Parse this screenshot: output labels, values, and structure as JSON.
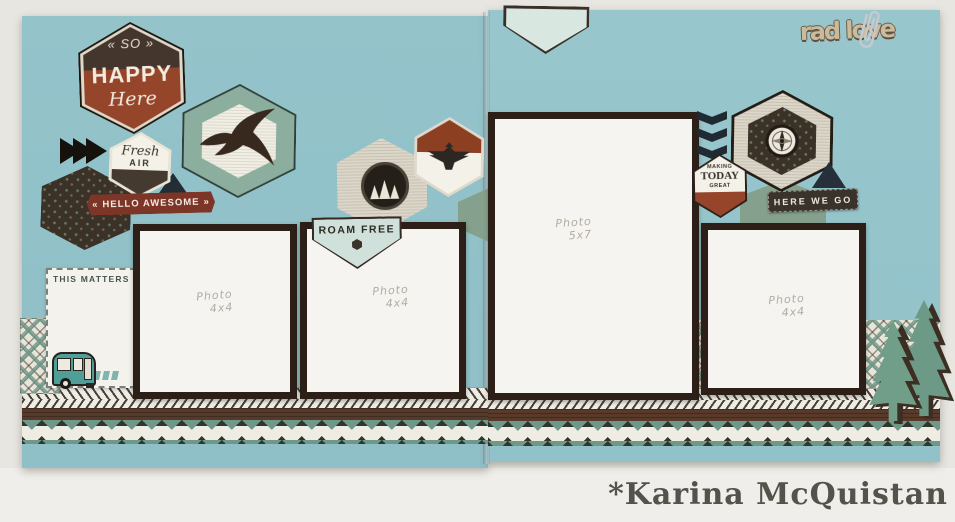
{
  "left_page": {
    "happy_hex": {
      "so": "« SO »",
      "happy": "HAPPY",
      "here": "Here"
    },
    "fresh_air_hex": {
      "fresh": "Fresh",
      "air": "AIR"
    },
    "hello_awesome_banner": {
      "left_arrow": "«",
      "text": "HELLO AWESOME",
      "right_arrow": "»"
    },
    "this_matters_card": {
      "title": "THIS MATTERS"
    },
    "roam_free_pennant": {
      "text": "ROAM FREE"
    },
    "photo_slots": [
      {
        "line1": "Photo",
        "line2": "4x4"
      },
      {
        "line1": "Photo",
        "line2": "4x4"
      }
    ]
  },
  "right_page": {
    "rad_word": {
      "text": "rad love"
    },
    "making_today_hex": {
      "line1": "MAKING",
      "line2": "TODAY",
      "line3": "GREAT"
    },
    "here_we_go_banner": {
      "text": "HERE WE GO"
    },
    "photo_slots": [
      {
        "line1": "Photo",
        "line2": "5x7"
      },
      {
        "line1": "Photo",
        "line2": "4x4"
      }
    ]
  },
  "watermark": {
    "text": "*Karina McQuistan"
  },
  "icons": {
    "eagle": "soaring-eagle-silhouette",
    "thunderbird": "thunderbird-silhouette",
    "compass": "compass-dial",
    "pine_badge": "pine-trees-circle-badge",
    "camper": "vintage-camper-trailer",
    "pine_tree": "pine-tree-die-cut",
    "paperclip": "paperclip",
    "triple_arrows": "three-right-arrows",
    "chevrons_down": "triple-chevron-down",
    "triangle": "triangle-accent"
  },
  "colors": {
    "page_teal": "#94c3ca",
    "mat_brown": "#2b1f18",
    "rust_red": "#96452a",
    "charcoal_brown": "#45362d",
    "sage_green": "#6d9a86",
    "mint": "#d2e3dd",
    "navy": "#232d35",
    "cream": "#f1eee4",
    "kraft_tan": "#cbbb9b",
    "maroon_banner": "#7c3526",
    "table_gray": "#e8e6e1"
  }
}
